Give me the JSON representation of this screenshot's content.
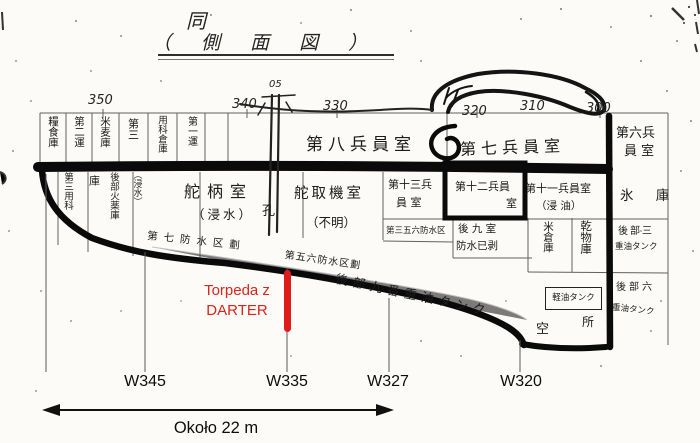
{
  "title": {
    "mark": "同",
    "caption": "（ 側 面 図 ）"
  },
  "stations": {
    "s350": "350",
    "s340": "340",
    "s05": "05",
    "s330": "330",
    "s320": "320",
    "s310": "310",
    "s300": "300"
  },
  "storerooms_top": {
    "c1": "糧食庫",
    "c2": "第二運",
    "c3": "米麦庫",
    "c4": "第三",
    "c5": "用科倉庫",
    "c6": "第一運"
  },
  "upper_deck": {
    "crew8": "第八兵員室",
    "crew7": "第七兵員室",
    "crew6_l1": "第六兵",
    "crew6_l2": "員 室"
  },
  "middle_deck": {
    "tiller": "舵柄室",
    "tiller_note": "（浸水）",
    "hole": "孔",
    "steering": "舵取機室",
    "steering_note": "（不明）",
    "crew13_l1": "第十三兵",
    "crew13_l2": "員 室",
    "crew12_l1": "第十二兵員",
    "crew12_l2": "室",
    "crew11": "第十一兵員室",
    "crew11_note": "（浸 油）",
    "ice": "氷 庫"
  },
  "lower_left": {
    "c1": "第三用科",
    "c2": "庫",
    "c3": "後部火薬庫",
    "c4": "（浸水）"
  },
  "lower_cells": {
    "ward356": "第三五六防水区",
    "aft9_l1": "後 九 室",
    "aft9_l2": "防水已剥",
    "rice": "米倉庫",
    "dried": "乾物庫",
    "oil3_l1": "後部三",
    "oil3_l2": "重油タンク",
    "light_oil": "軽油タンク",
    "oil6_l1": "後部六",
    "oil6_l2": "重油タンク",
    "void1": "空",
    "void2": "所"
  },
  "hull_notes": {
    "ward7": "第七防水区劃",
    "ward56": "第五六防水区劃",
    "oil9": "後部九番重油タンク"
  },
  "annotations": {
    "torpedo_l1": "Torpeda z",
    "torpedo_l2": "DARTER",
    "w345": "W345",
    "w335": "W335",
    "w327": "W327",
    "w320": "W320",
    "scale": "Około 22 m"
  },
  "colors": {
    "annotation_red": "#d9241c",
    "ink": "#0a0a0a"
  }
}
